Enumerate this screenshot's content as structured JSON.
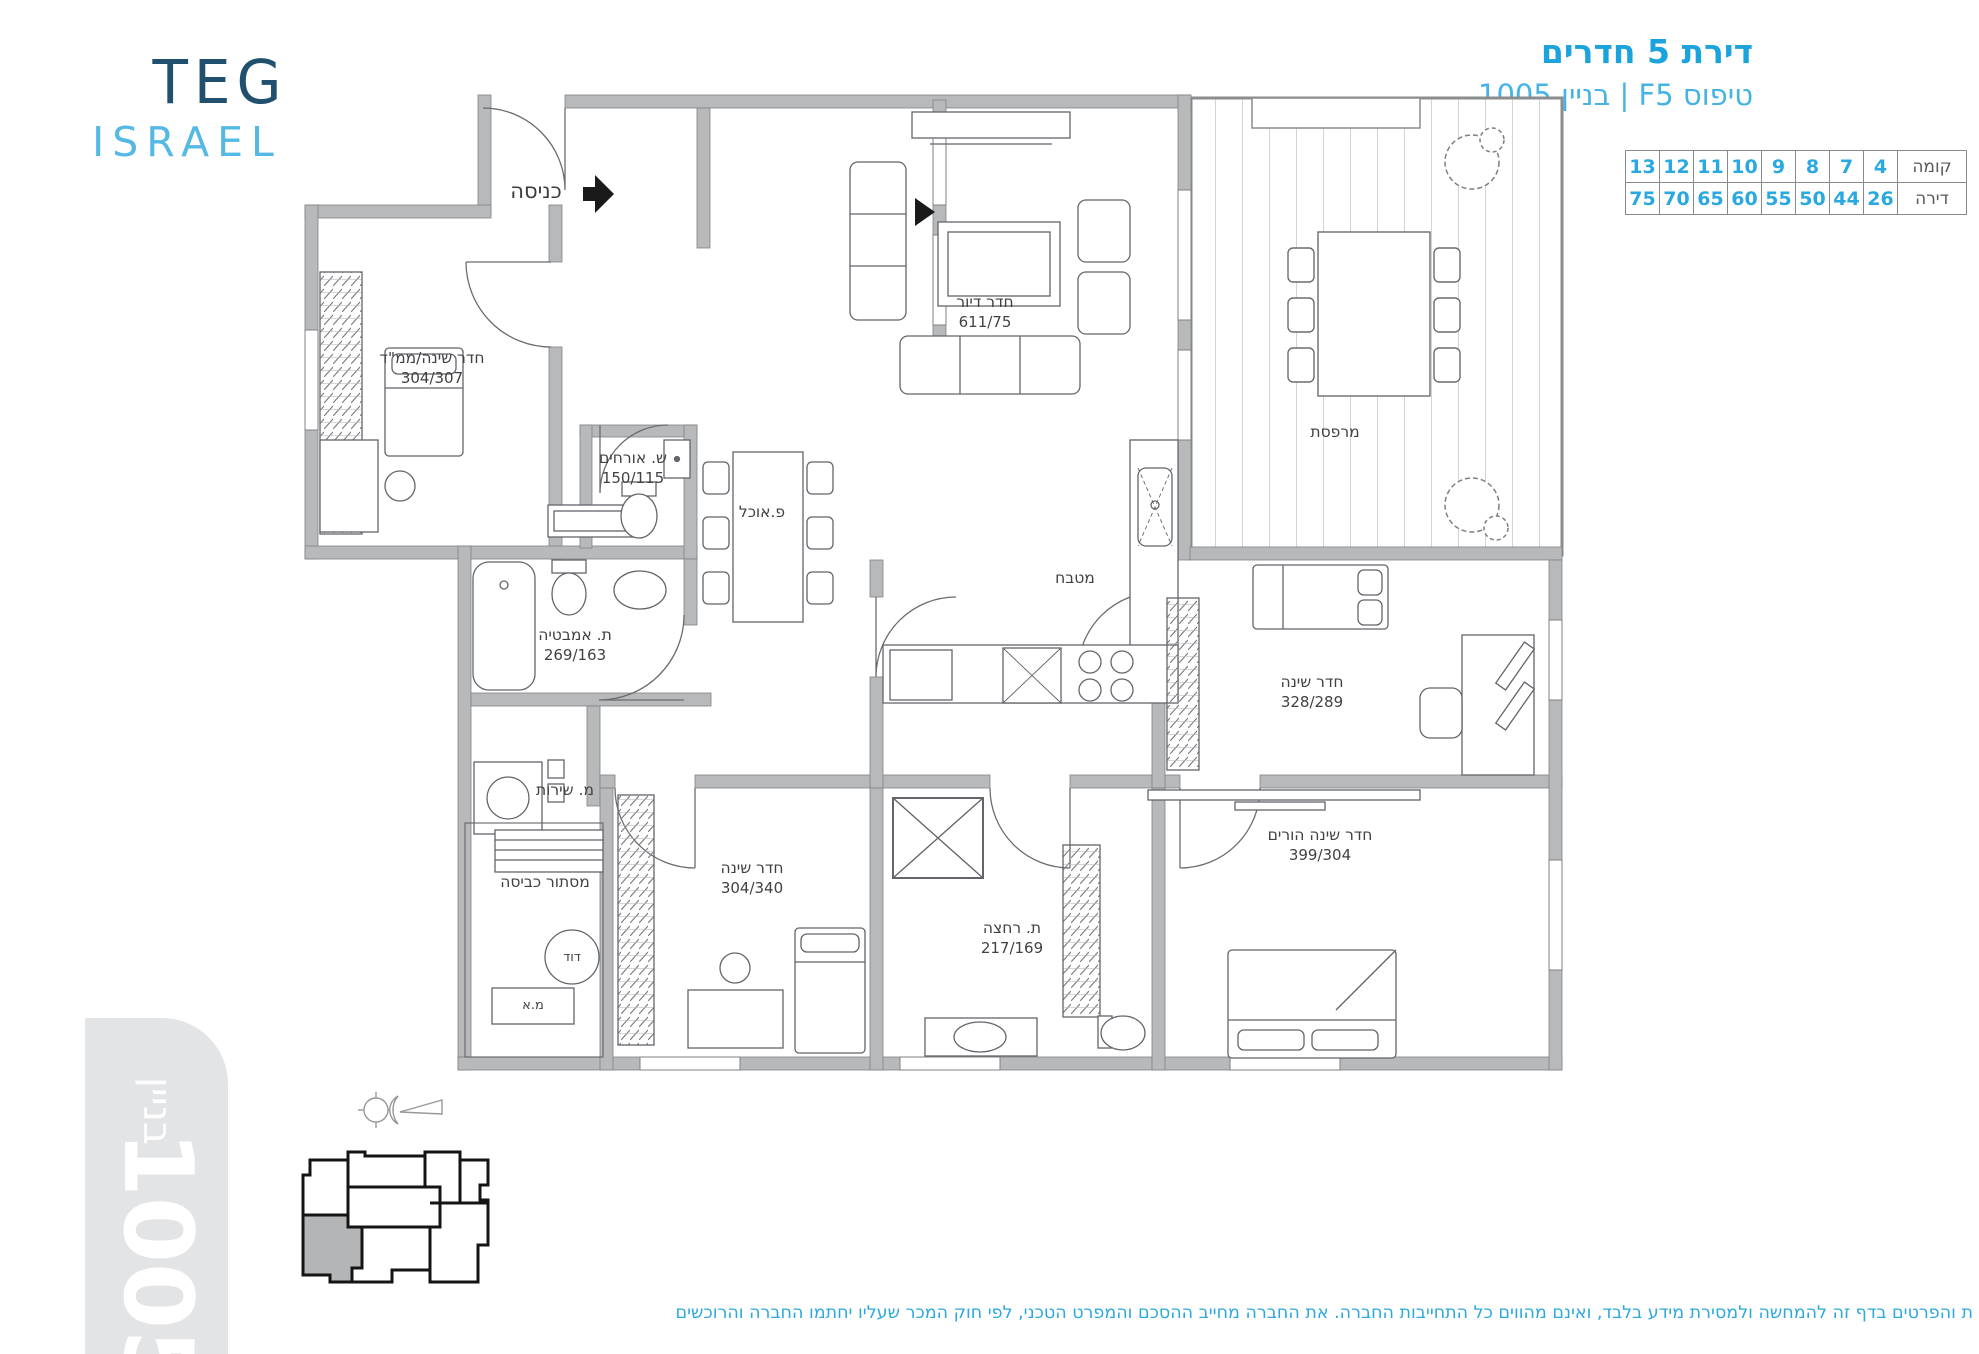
{
  "logo": {
    "line1": "TEG",
    "line2": "ISRAEL"
  },
  "header": {
    "title": "דירת 5 חדרים",
    "subtitle": "טיפוס F5 | בניין 1005"
  },
  "units_table": {
    "floor_label": "קומה",
    "apt_label": "דירה",
    "floors": [
      "13",
      "12",
      "11",
      "10",
      "9",
      "8",
      "7",
      "4"
    ],
    "apartments": [
      "75",
      "70",
      "65",
      "60",
      "55",
      "50",
      "44",
      "26"
    ]
  },
  "plan": {
    "entrance_label": "כניסה",
    "rooms": {
      "mamad": {
        "name": "חדר שינה/ממ\"ד",
        "dims": "304/307"
      },
      "living": {
        "name": "חדר דיור",
        "dims": "611/75"
      },
      "wc": {
        "name": "ש. אורחים",
        "dims": "150/115"
      },
      "dining": {
        "name": "פ.אוכל"
      },
      "kitchen": {
        "name": "מטבח"
      },
      "balcony": {
        "name": "מרפסת"
      },
      "bath": {
        "name": "ת. אמבטיה",
        "dims": "269/163"
      },
      "service": {
        "name": "מ. שירות"
      },
      "laundry": {
        "name": "מסתור כביסה"
      },
      "boiler": {
        "name": "דוד"
      },
      "ac": {
        "name": "מ.א"
      },
      "bed2": {
        "name": "חדר שינה",
        "dims": "304/340"
      },
      "bath2": {
        "name": "ת. רחצה",
        "dims": "217/169"
      },
      "bed3": {
        "name": "חדר שינה",
        "dims": "328/289"
      },
      "parents": {
        "name": "חדר שינה הורים",
        "dims": "399/304"
      }
    }
  },
  "building_badge": {
    "label": "בניין",
    "number": "1005"
  },
  "footer": {
    "disclaimer": "ת והפרטים בדף זה להמחשה ולמסירת מידע בלבד, ואינם מהווים כל התחייבות החברה. את החברה מחייב ההסכם והמפרט הטכני, לפי חוק המכר שעליו יחתמו החברה והרוכשים"
  },
  "colors": {
    "accent_blue": "#1ba3dd",
    "light_blue": "#55b9e6",
    "dark_blue": "#20506e",
    "wall_gray": "#b7b9bb",
    "badge_gray": "#e3e4e6"
  }
}
